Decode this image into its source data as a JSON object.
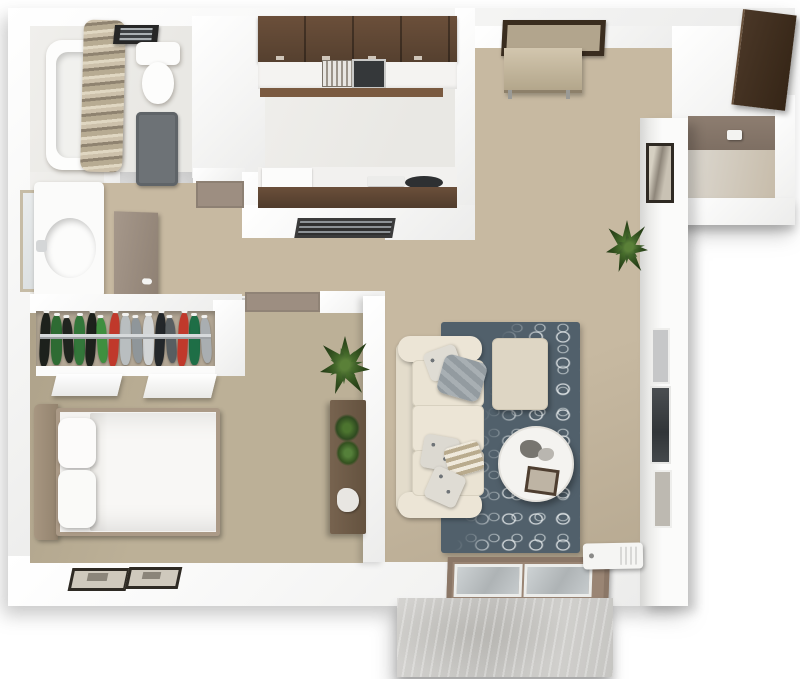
{
  "meta": {
    "title": "3D top-down floor plan render — one-bedroom apartment",
    "view": "overhead 3D dollhouse",
    "background": "#ffffff"
  },
  "palette": {
    "wall": "#fbfbfa",
    "wallShade": "#e3e3e1",
    "carpet": "#c7b9a1",
    "carpetDark": "#bcb097",
    "tile": "#edecea",
    "walnut": "#5d4534",
    "walnutLight": "#7a5a40",
    "taupe": "#9d8e81",
    "taupeDark": "#8d7d70",
    "rug": "#51606b",
    "rugPattern": "#e8edee",
    "cream": "#eae3d3",
    "creamDark": "#d8d1bf",
    "linen": "#f6f5f3",
    "concrete": "#cac9c6",
    "bronze": "#8b7767",
    "glass": "#c2c7c9",
    "matFrame": "#3a2d1f",
    "matCenter": "#b2a58d",
    "wood": "#6e5b49",
    "plantGreen": "#3c5c28",
    "applianceDark": "#2e3032",
    "bathMat": "#6d7276",
    "storageDoor": "#41301f",
    "tvScreen": "#3c4043"
  },
  "rooms": {
    "bathroom": {
      "label": "bathroom"
    },
    "vanity": {
      "label": "vanity nook"
    },
    "dressing_hall": {
      "label": "dressing hallway"
    },
    "closet": {
      "label": "wardrobe closet"
    },
    "bedroom": {
      "label": "bedroom"
    },
    "kitchen": {
      "label": "galley kitchen"
    },
    "hallway": {
      "label": "hallway"
    },
    "entry": {
      "label": "entry area"
    },
    "living": {
      "label": "living room"
    },
    "storage": {
      "label": "exterior storage closet"
    },
    "patio": {
      "label": "concrete patio"
    }
  },
  "closet": {
    "garments": [
      "#1d211c",
      "#2e6b33",
      "#20241f",
      "#33773a",
      "#1d211c",
      "#3f8f3f",
      "#c0392b",
      "#b9bec0",
      "#8f969a",
      "#d2d5d6",
      "#23272a",
      "#585e61",
      "#c0392b",
      "#1e6e46",
      "#a9aeb1"
    ],
    "rod": "chrome closet rod"
  },
  "furniture": {
    "bathtub": {
      "label": "bathtub with beige shower curtain"
    },
    "toilet": {
      "label": "toilet"
    },
    "ceiling_vent": {
      "label": "bathroom ceiling vent fan"
    },
    "bath_mat": {
      "label": "dark gray bath mat"
    },
    "mirror": {
      "label": "framed vanity mirror"
    },
    "vanity_sink": {
      "label": "vanity counter with oval sink"
    },
    "hall_door": {
      "label": "open taupe interior door"
    },
    "bath_threshold": {
      "label": "taupe door threshold"
    },
    "upper_cabinets": {
      "label": "walnut upper cabinets"
    },
    "kitchen_sink": {
      "label": "kitchen sink with drainboard"
    },
    "lower_counter": {
      "label": "kitchen counter with walnut edge"
    },
    "dishwasher": {
      "label": "dishwasher"
    },
    "cooktop": {
      "label": "dark cooktop"
    },
    "range_vent": {
      "label": "range vent grill"
    },
    "entry_mat": {
      "label": "framed entry door mat"
    },
    "entry_door": {
      "label": "open entry door leaf"
    },
    "storage_door": {
      "label": "dark brown storage door, open"
    },
    "thermostat": {
      "label": "wall control box"
    },
    "column_art": {
      "label": "framed wall art"
    },
    "window_upper": {
      "label": "wall niche window"
    },
    "tv": {
      "label": "wall-mounted TV"
    },
    "window_lower": {
      "label": "wall niche window"
    },
    "living_plant": {
      "label": "potted plant"
    },
    "sofa": {
      "label": "cream three-seat sofa with throw pillows"
    },
    "ottoman": {
      "label": "cream ottoman"
    },
    "coffee_table": {
      "label": "round white coffee table with decor"
    },
    "rug": {
      "label": "slate blue rug with white fan pattern"
    },
    "bed": {
      "label": "double bed with white duvet and pillows"
    },
    "console": {
      "label": "wood console with plants"
    },
    "bedroom_plant": {
      "label": "tall potted plant"
    },
    "bedroom_art": {
      "label": "two framed pictures on south wall"
    },
    "closet_doors": {
      "label": "white sliding closet doors"
    },
    "sliding_door": {
      "label": "bronze framed sliding glass door"
    },
    "ac_unit": {
      "label": "white wall AC unit"
    },
    "patio_slab": {
      "label": "concrete patio slab"
    }
  }
}
